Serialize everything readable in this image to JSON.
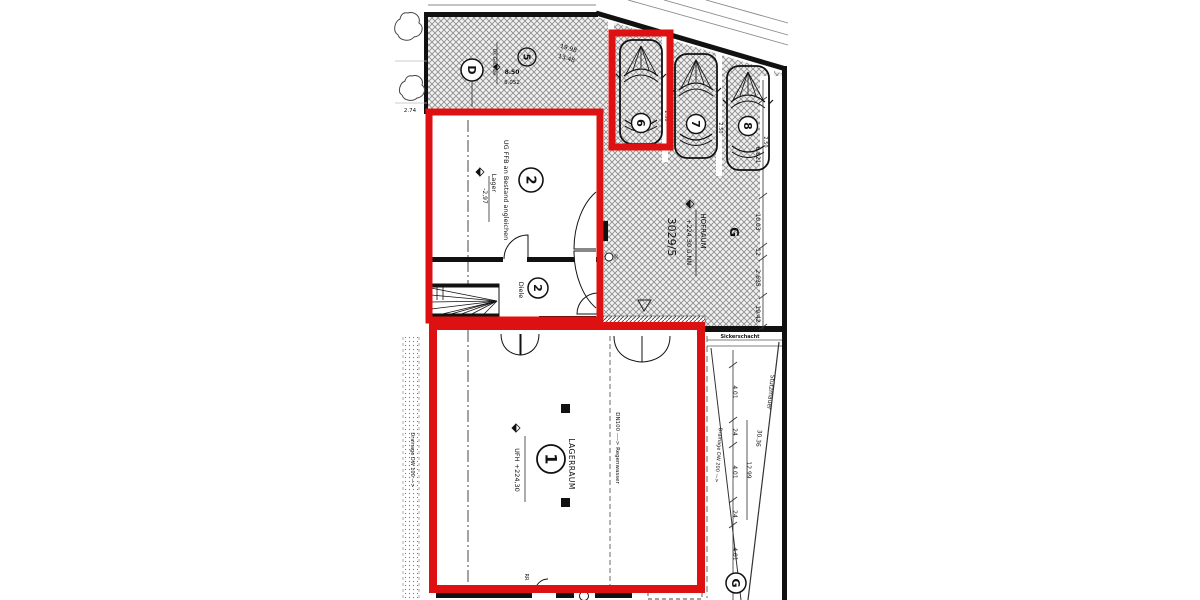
{
  "annotation": {
    "highlight_color": "#dd1111"
  },
  "rooms": {
    "lager": {
      "number": "2",
      "note": "UG FFB an Bestand angleichen",
      "name": "Lager",
      "elevation": "-2,97"
    },
    "diele": {
      "number": "2",
      "name": "Diele"
    },
    "lagerraum": {
      "number": "1",
      "name": "LAGERRAUM",
      "elevation": "UFH +224,30",
      "rr": "RR"
    },
    "hofraum": {
      "name": "HOFRAUM",
      "elevation": "+224,30 ü.NN",
      "parcel": "3029/5"
    }
  },
  "parking": {
    "car_numbers": [
      "6",
      "7",
      "8"
    ],
    "bay_width": "2.50"
  },
  "markers": {
    "d": "D",
    "five": "5",
    "g_top": "G",
    "g_bottom": "G"
  },
  "site": {
    "top_dims": {
      "a": "19.98",
      "b": "13.48"
    },
    "bench": {
      "label": "OK Gelände",
      "v1": "8.50",
      "v2": "8.052"
    },
    "left_dim": "2.74",
    "right_chain": [
      "6.821",
      "10.03",
      "12",
      "2.635",
      "19.42"
    ],
    "drive_chain": [
      "4.01",
      "24",
      "4.01",
      "24",
      "4.01"
    ],
    "drive_total": "12.99",
    "drive_diag": "30.36",
    "stuetzmauer": "Stützmauer",
    "sicker": "Sickerschacht",
    "dn100": "DN100 ----> Regenwasser",
    "drain_left": "Drainage DW 100 —>",
    "drain_drive": "Drainage DW 200 —>",
    "re": "RE"
  }
}
